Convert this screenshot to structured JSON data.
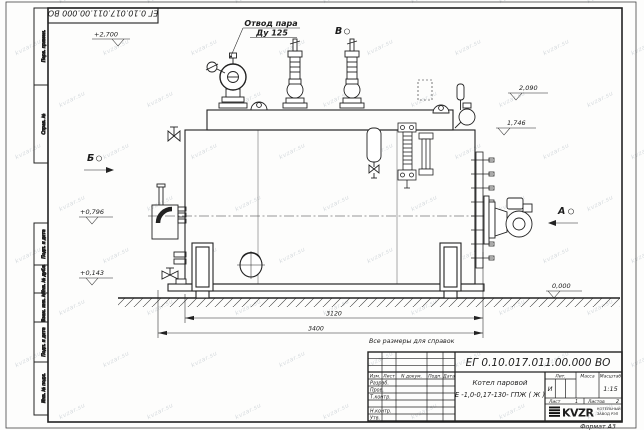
{
  "watermark": {
    "text": "kvzar.su"
  },
  "frame": {
    "top_doc_number": "ЕГ 0.10.017.011.00.000 ВО",
    "stamp_vertical_top": [
      "Перв. примен.",
      "Справ. №"
    ],
    "stamp_vertical_bottom": [
      "Подп. и дата",
      "Инв. № дубл.",
      "Взам. инв. №",
      "Подп. и дата",
      "Инв. № подл."
    ]
  },
  "drawing": {
    "steam_outlet": {
      "line1": "Отвод пара",
      "line2": "Ду 125"
    },
    "views": {
      "left": "Б",
      "top": "В",
      "right": "А"
    },
    "elevations": {
      "top": "+2,700",
      "mid_left": "+0,796",
      "low_left": "+0,143",
      "right_upper": "2,090",
      "right_lower": "1,746",
      "ground": "0,000"
    },
    "dimensions": {
      "between_supports": "3120",
      "overall_length": "3400"
    },
    "note": "Все размеры для справок"
  },
  "title_block": {
    "doc_number": "ЕГ 0.10.017.011.00.000  ВО",
    "product_name_line1": "Котел паровой",
    "product_name_line2": "Е -1,0-0,17-130- ГПЖ ( Ж )",
    "header_cols": [
      "Изм.",
      "Лист",
      "N докум.",
      "Подп.",
      "Дата"
    ],
    "sign_rows": [
      "Разраб.",
      "Пров.",
      "Т.контр.",
      "",
      "Н.контр.",
      "Утв."
    ],
    "lit_label": "Лит.",
    "lit_value": "И",
    "mass_label": "Масса",
    "scale_label": "Масштаб",
    "scale_value": "1:15",
    "sheet_label": "Лист",
    "sheet_value": "1",
    "sheets_label": "Листов",
    "sheets_value": "2",
    "company": "KVZR",
    "company_sub1": "КОТЕЛЬНЫЙ",
    "company_sub2": "ЗАВОД РЭП",
    "format_note": "Формат А3"
  }
}
